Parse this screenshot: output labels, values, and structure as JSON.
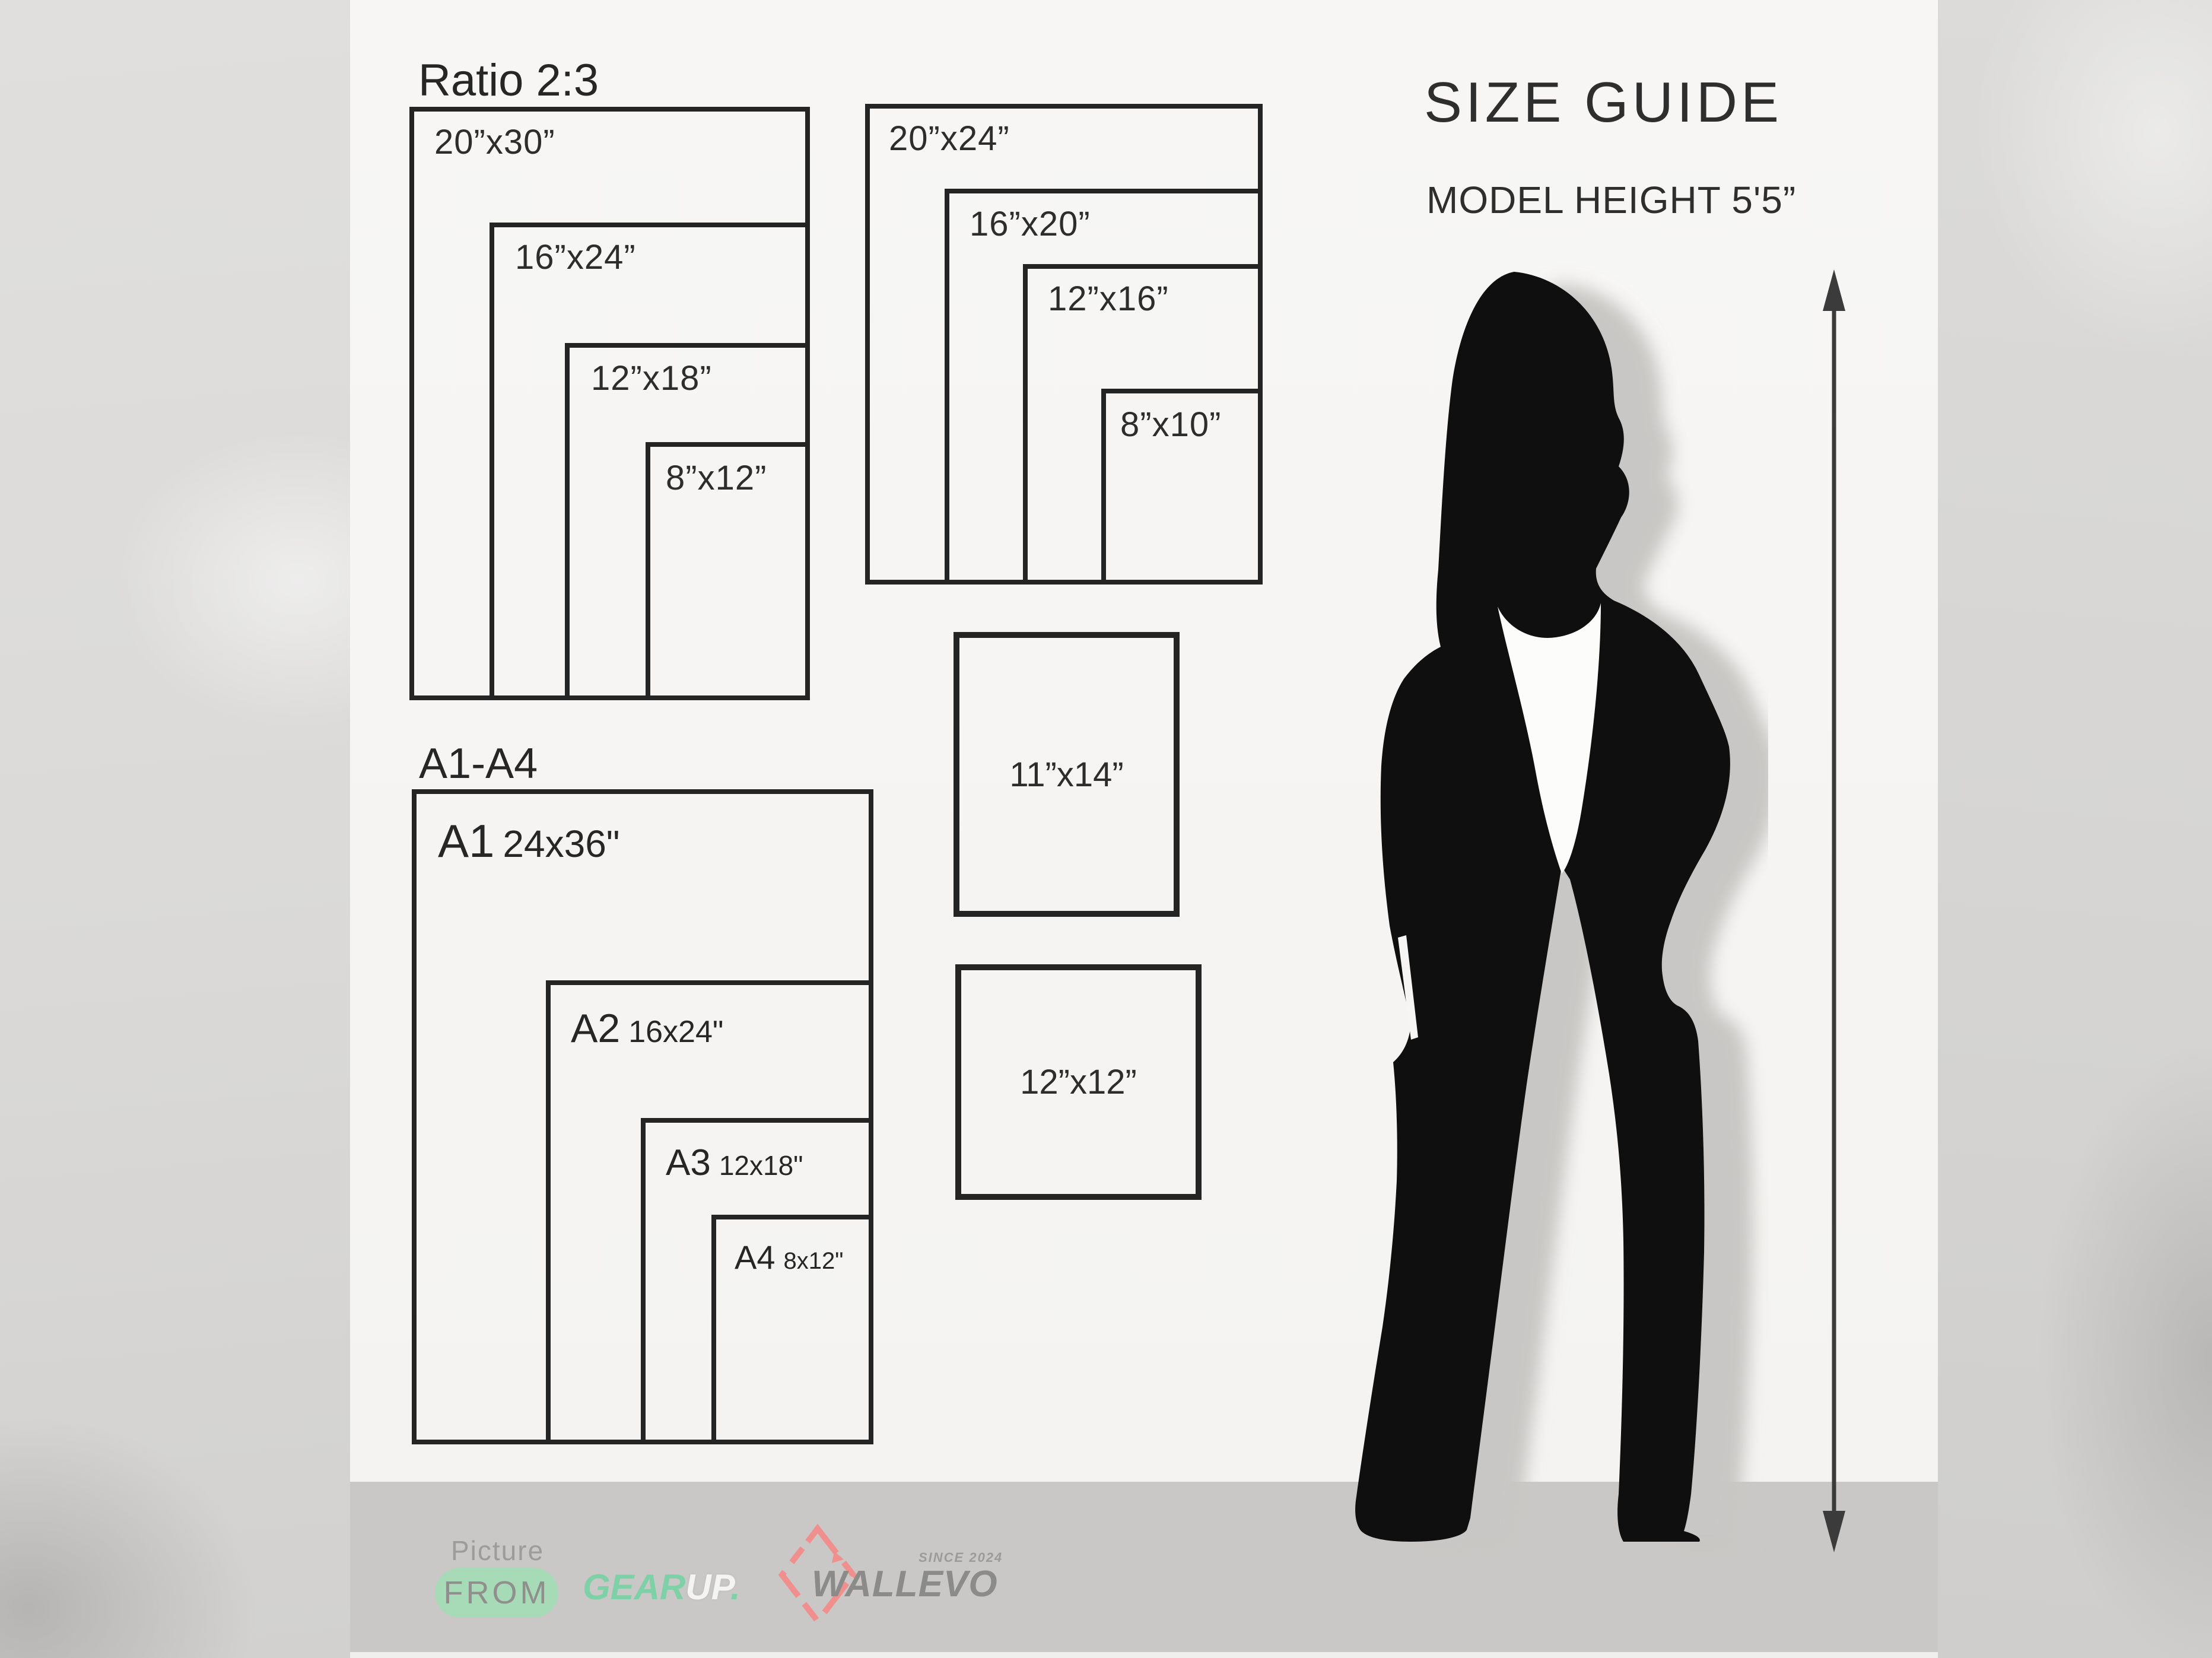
{
  "header": {
    "title": "SIZE GUIDE",
    "subtitle": "MODEL HEIGHT 5'5”"
  },
  "ratio_group": {
    "title": "Ratio 2:3",
    "sizes": [
      "20”x30”",
      "16”x24”",
      "12”x18”",
      "8”x12”"
    ]
  },
  "standard_group": {
    "sizes": [
      "20”x24”",
      "16”x20”",
      "12”x16”",
      "8”x10”"
    ]
  },
  "a_group": {
    "title": "A1-A4",
    "items": [
      {
        "code": "A1",
        "size": "24x36\""
      },
      {
        "code": "A2",
        "size": "16x24\""
      },
      {
        "code": "A3",
        "size": "12x18\""
      },
      {
        "code": "A4",
        "size": "8x12\""
      }
    ]
  },
  "single_boxes": {
    "portrait": "11”x14”",
    "square": "12”x12”"
  },
  "footer": {
    "picture": "Picture",
    "from": "FROM",
    "brand_gear": "GEAR",
    "brand_up": "UP",
    "brand_dot": ".",
    "brand_wall": "WALLEVO",
    "since": "SINCE 2024"
  },
  "colors": {
    "line": "#242424",
    "paper": "#f6f5f3",
    "band": "#cac8c6",
    "mint_pill": "#a7dab6",
    "mint_text": "#7ed0a6",
    "brand_gray": "#8b8b89",
    "diamond_red": "#f0908e",
    "silhouette": "#0f0f0f"
  }
}
